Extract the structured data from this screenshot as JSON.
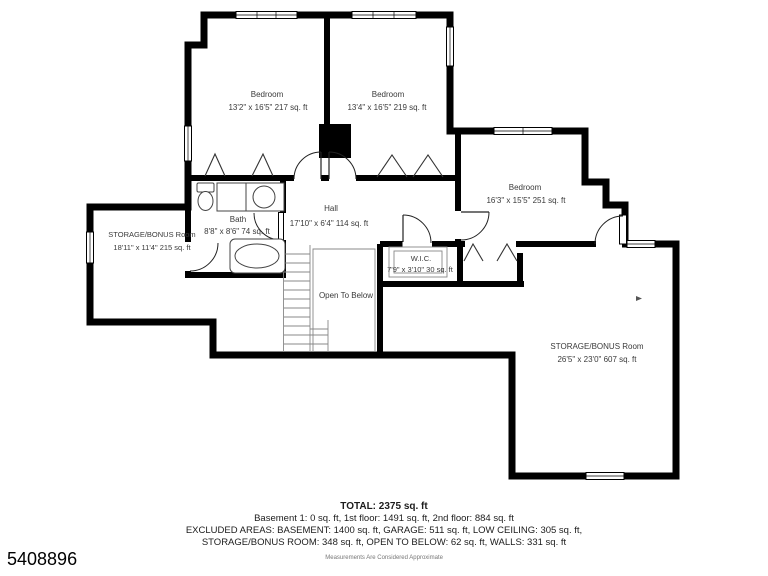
{
  "rooms": {
    "bedroom1": {
      "name": "Bedroom",
      "dims": "13'2\" x 16'5\" 217 sq. ft"
    },
    "bedroom2": {
      "name": "Bedroom",
      "dims": "13'4\" x 16'5\" 219 sq. ft"
    },
    "bedroom3": {
      "name": "Bedroom",
      "dims": "16'3\" x 15'5\" 251 sq. ft"
    },
    "bath": {
      "name": "Bath",
      "dims": "8'8\" x 8'6\" 74 sq. ft"
    },
    "hall": {
      "name": "Hall",
      "dims": "17'10\" x 6'4\" 114 sq. ft"
    },
    "wic": {
      "name": "W.I.C.",
      "dims": "7'9\" x 3'10\" 30 sq. ft"
    },
    "storage_left": {
      "name": "STORAGE/BONUS Room",
      "dims": "18'11\" x 11'4\" 215 sq. ft"
    },
    "storage_right": {
      "name": "STORAGE/BONUS Room",
      "dims": "26'5\" x 23'0\" 607 sq. ft"
    },
    "open_to_below": {
      "name": "Open To Below"
    }
  },
  "summary": {
    "total": "TOTAL: 2375 sq. ft",
    "floors": "Basement 1: 0 sq. ft, 1st floor: 1491 sq. ft, 2nd floor: 884 sq. ft",
    "excluded_line1": "EXCLUDED AREAS: BASEMENT: 1400 sq. ft, GARAGE: 511 sq. ft, LOW CEILING: 305 sq. ft,",
    "excluded_line2": "STORAGE/BONUS ROOM: 348 sq. ft, OPEN TO BELOW: 62 sq. ft, WALLS: 331 sq. ft"
  },
  "footer": {
    "listing_id": "5408896",
    "disclaimer": "Measurements Are Considered Approximate"
  }
}
